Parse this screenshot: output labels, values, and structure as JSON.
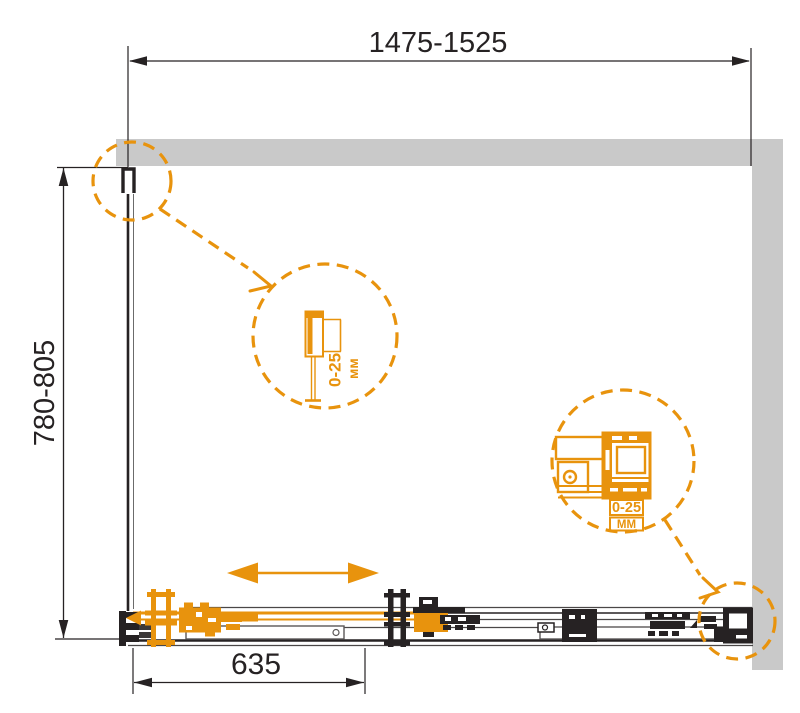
{
  "diagram": {
    "subject": "Corner shower enclosure installation drawing, top view",
    "dimensions": {
      "overall_width_range": "1475-1525",
      "overall_depth_range": "780-805",
      "door_panel_width": "635"
    },
    "callouts": {
      "wall_profile": {
        "adjustment_range": "0-25",
        "unit": "мм"
      },
      "roller_bracket": {
        "adjustment_range": "0-25",
        "unit": "ММ"
      }
    },
    "colors": {
      "accent_orange": "#E8930D",
      "wall_gray": "#C9C9C9",
      "line_dark": "#262223"
    }
  }
}
